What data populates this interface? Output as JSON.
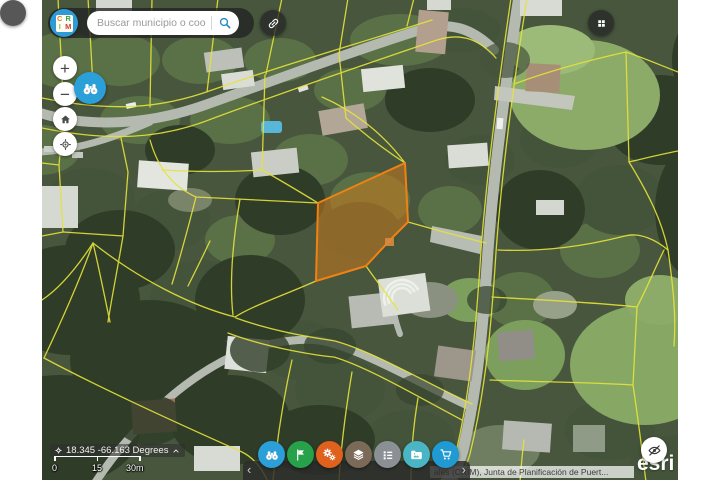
{
  "logo": {
    "letters": {
      "c": "C",
      "r": "R",
      "i": "I",
      "m": "M"
    }
  },
  "search": {
    "placeholder": "Buscar municipio o coordenada"
  },
  "controls": {
    "zoom_in": "+",
    "zoom_out": "−"
  },
  "coordinates": {
    "value": "18.345 -66.163 Degrees"
  },
  "scale_bar": {
    "t0": "0",
    "t1": "15",
    "t2": "30m"
  },
  "toolbar": {
    "prev": "‹",
    "next": "›",
    "buttons": [
      {
        "name": "search-binoculars",
        "color": "#2b9fd8"
      },
      {
        "name": "flag-bookmarks",
        "color": "#28a14b"
      },
      {
        "name": "tools-gears",
        "color": "#e0611d"
      },
      {
        "name": "layers",
        "color": "#7c6a58"
      },
      {
        "name": "legend",
        "color": "#8b9095"
      },
      {
        "name": "image-gallery",
        "color": "#4ab5c4"
      },
      {
        "name": "cart",
        "color": "#1f9ad3"
      }
    ]
  },
  "attribution": {
    "visible_text": "ales (CRIM), Junta de Planificación de Puert...",
    "esri_logo": "esri"
  },
  "map": {
    "parcel_highlight": {
      "stroke": "#f08214",
      "fill": "#c87a1e"
    },
    "parcel_line_color": "#e6e33a"
  }
}
